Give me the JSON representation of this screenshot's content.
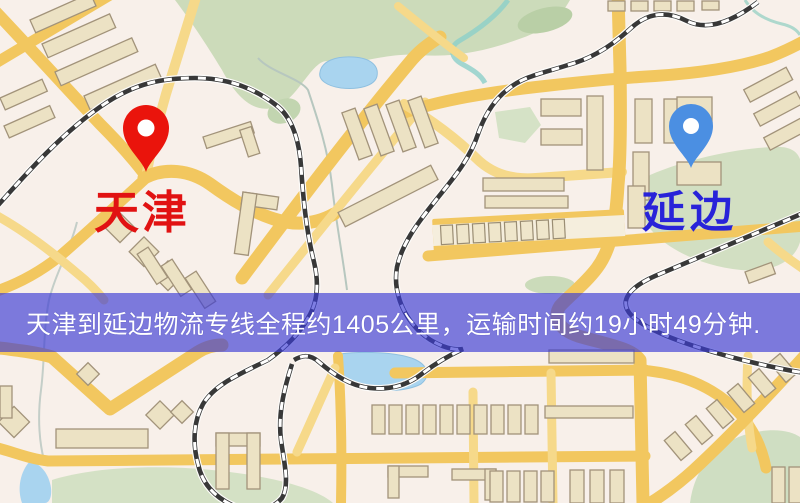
{
  "map": {
    "banner": {
      "text": "天津到延边物流专线全程约1405公里，运输时间约19小时49分钟.",
      "background_color": "#3b3bd4",
      "overlay_opacity": "0.66",
      "text_color": "#ffffff"
    },
    "markers": [
      {
        "id": "origin",
        "label": "天津",
        "pin_color": "#ea140c",
        "label_color": "#e11212"
      },
      {
        "id": "destination",
        "label": "延边",
        "pin_color": "#4b8fe2",
        "label_color": "#2823d9"
      }
    ],
    "colors": {
      "background": "#f8f0ea",
      "road_main": "#f2c75f",
      "road_minor": "#f6d98a",
      "building_fill": "#ece2c4",
      "building_stroke": "#a2937a",
      "green_area": "#ccdbba",
      "water": "#a9d4ef",
      "railway": "#383838"
    }
  }
}
